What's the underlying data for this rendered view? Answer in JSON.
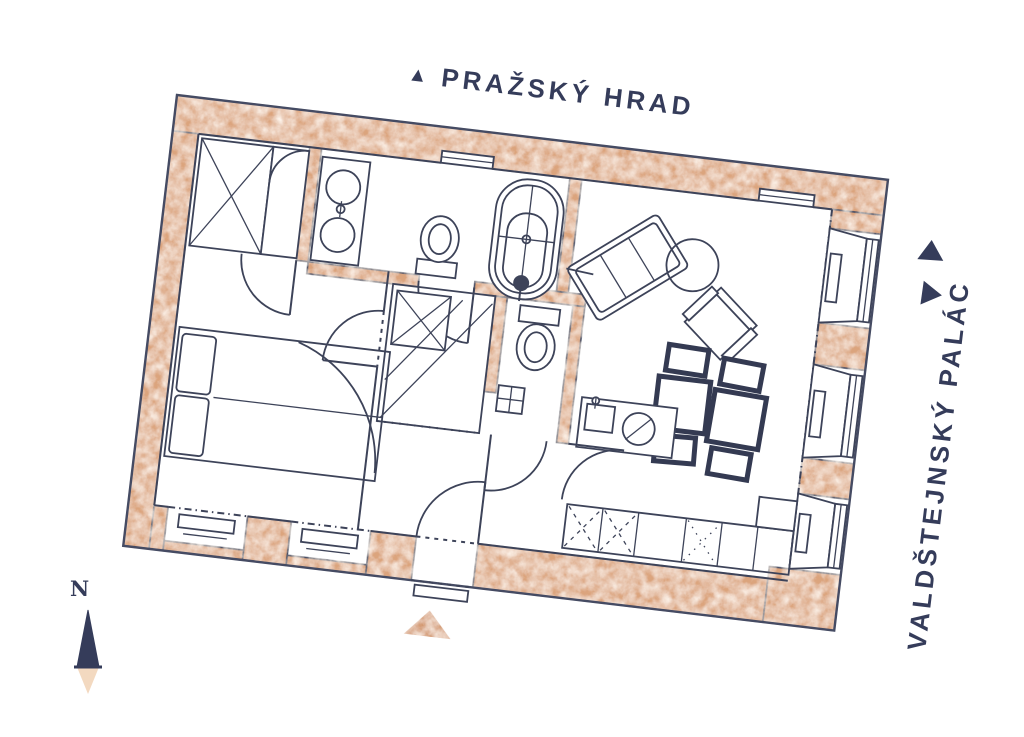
{
  "page": {
    "background": "#ffffff"
  },
  "labels": {
    "top": {
      "arrow": "▲",
      "text": "PRAŽSKÝ HRAD"
    },
    "right": {
      "text": "VALDŠTEJNSKÝ PALÁC",
      "arrows": [
        "up-triangle",
        "right-triangle"
      ]
    },
    "compass": {
      "letter": "N"
    }
  },
  "colors": {
    "wall": "#dba47d",
    "wall_light": "#f3d9c0",
    "line": "#3d4359",
    "text": "#353c5a",
    "entrance_marker": "#d2956a",
    "compass_needle_dark": "#353c5a",
    "compass_needle_light": "#f3d9c0"
  },
  "plan_features": [
    "double-bed",
    "pillows",
    "wardrobe",
    "closet-with-door",
    "double-sink-vanity",
    "bathtub",
    "bathroom-toilet",
    "wc-toilet",
    "hand-basin",
    "washing-machine",
    "sofa-daybed",
    "round-table",
    "armchair",
    "dining-tables",
    "dining-chairs",
    "kitchen-island",
    "hob",
    "kitchen-sink",
    "kitchen-counter-row",
    "tall-unit",
    "window-niches",
    "radiators",
    "entrance-door",
    "interior-door-swings",
    "north-compass-needle",
    "entrance-marker-triangle"
  ]
}
